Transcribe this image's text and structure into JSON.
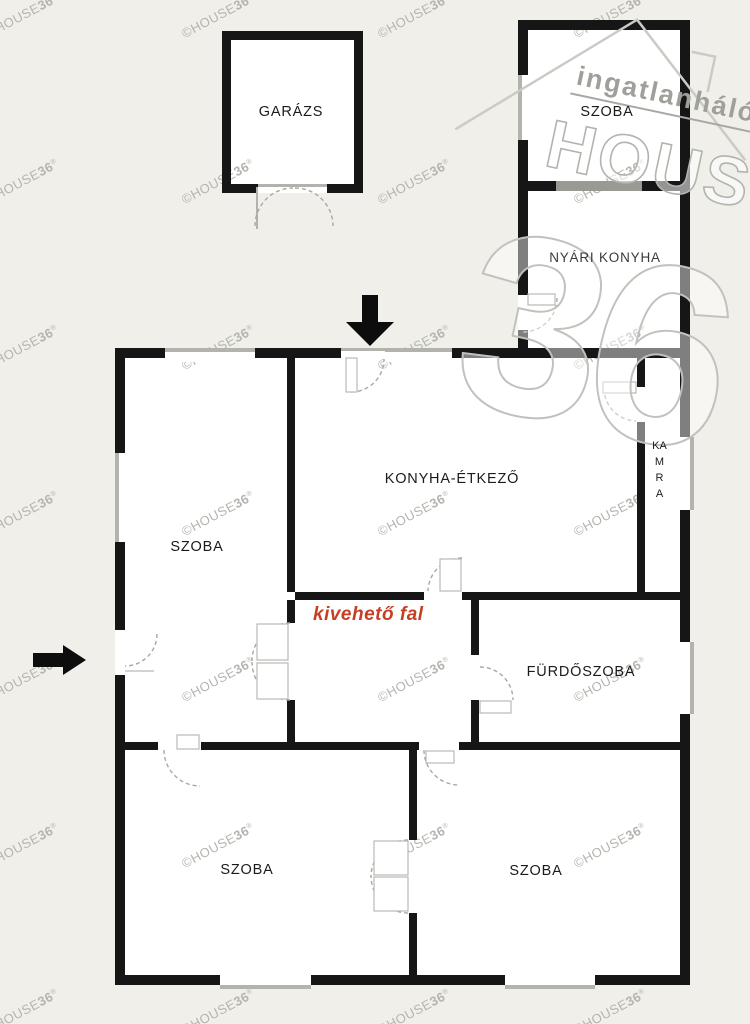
{
  "plan": {
    "title": "family house floor plan",
    "background_color": "#f0efea",
    "wall_color": "#161616",
    "window_color": "#b3b3ad",
    "rooms": [
      {
        "id": "garage",
        "label": "GARÁZS"
      },
      {
        "id": "szoba-top",
        "label": "SZOBA"
      },
      {
        "id": "nyari-konyha",
        "label": "NYÁRI KONYHA"
      },
      {
        "id": "konyha-etkezo",
        "label": "KONYHA-ÉTKEZŐ"
      },
      {
        "id": "kamra",
        "label": "KAMRA"
      },
      {
        "id": "szoba-left",
        "label": "SZOBA"
      },
      {
        "id": "furdoszoba",
        "label": "FÜRDŐSZOBA"
      },
      {
        "id": "szoba-bottom-left",
        "label": "SZOBA"
      },
      {
        "id": "szoba-bottom-right",
        "label": "SZOBA"
      }
    ],
    "annotation": {
      "text": "kivehető fal",
      "color": "#c53f22"
    }
  },
  "watermark": {
    "tile_name": "©HOUSE",
    "tile_number": "36",
    "tile_reg": "®",
    "logo_top": "ingatlanhálózat",
    "logo_main": "HOUSE",
    "logo_number": "36",
    "logo_color": "#a5a5a0"
  }
}
